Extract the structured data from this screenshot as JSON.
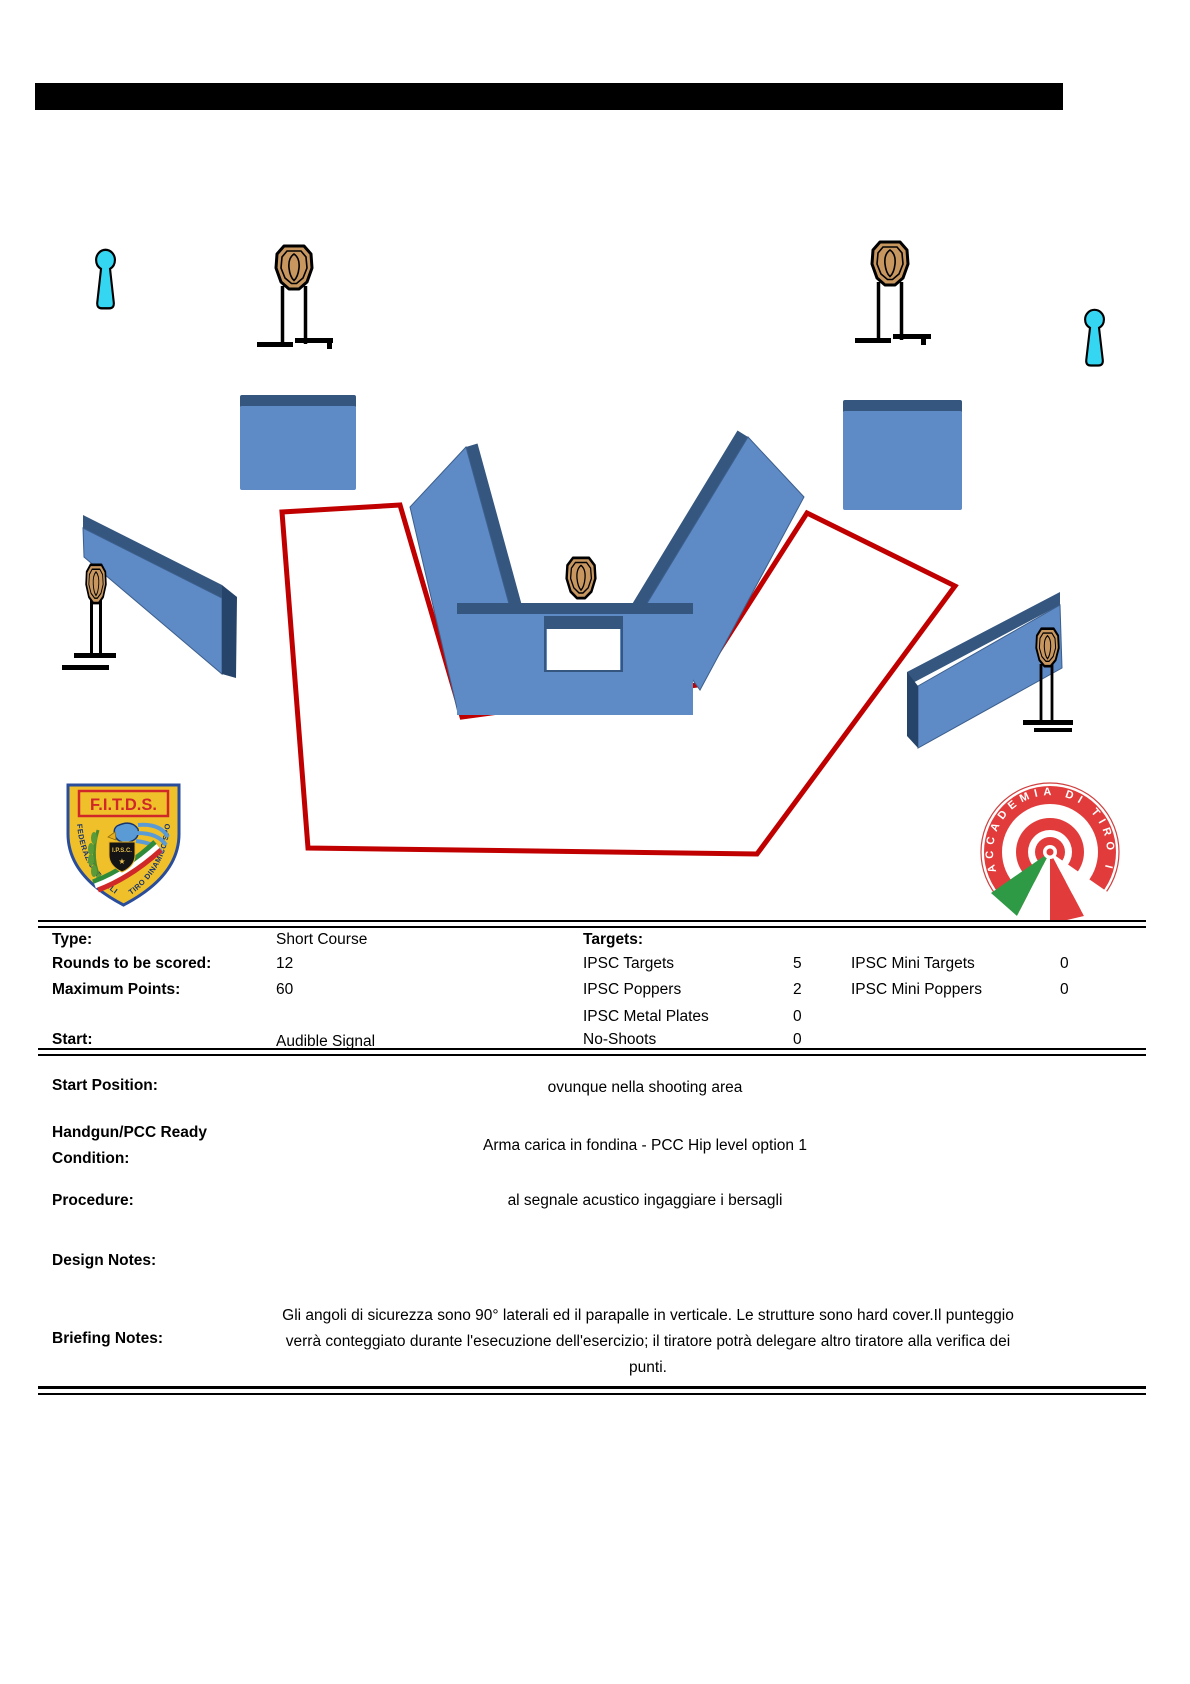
{
  "header": {
    "bar_present": true
  },
  "logos": {
    "fitds": {
      "title": "F.I.T.D.S.",
      "left_arc_text": "FEDERAZIONE ITALIANA",
      "right_arc_text": "TIRO DINAMICO SPORTIVO",
      "badge_text": "I.P.S.C.",
      "star": "★"
    },
    "accademia": {
      "ring_text": "ACCADEMIA DI TIRO ITALIANA"
    }
  },
  "info_table": {
    "type_label": "Type:",
    "type_value": "Short Course",
    "rounds_label": "Rounds to be scored:",
    "rounds_value": "12",
    "max_points_label": "Maximum Points:",
    "max_points_value": "60",
    "start_label": "Start:",
    "start_value": "Audible Signal",
    "targets_header": "Targets:",
    "target_counts": [
      {
        "label": "IPSC Targets",
        "value": "5",
        "mini_label": "IPSC Mini Targets",
        "mini_value": "0"
      },
      {
        "label": "IPSC Poppers",
        "value": "2",
        "mini_label": "IPSC Mini Poppers",
        "mini_value": "0"
      },
      {
        "label": "IPSC Metal Plates",
        "value": "0"
      },
      {
        "label": "No-Shoots",
        "value": "0"
      }
    ]
  },
  "details": {
    "start_position_label": "Start Position:",
    "start_position_value": "ovunque nella shooting area",
    "ready_condition_label_line1": "Handgun/PCC Ready",
    "ready_condition_label_line2": "Condition:",
    "ready_condition_value": "Arma carica in fondina - PCC Hip level option 1",
    "procedure_label": "Procedure:",
    "procedure_value": "al segnale acustico ingaggiare i bersagli",
    "design_notes_label": "Design Notes:",
    "briefing_label": "Briefing Notes:",
    "briefing_value": "Gli angoli di sicurezza sono 90° laterali ed il parapalle in verticale. Le strutture sono hard cover.Il punteggio verrà conteggiato durante l'esecuzione dell'esercizio; il tiratore potrà delegare altro tiratore alla verifica  dei punti."
  },
  "diagram": {
    "ipsc_target_count": 5,
    "popper_count": 2,
    "wall_count": 7,
    "colors": {
      "shooting_area_boundary": "#c00000",
      "wall_fill": "#5e8ac6",
      "wall_edge": "#34567f",
      "popper_fill": "#35d6f2",
      "target_fill": "#c89760"
    }
  }
}
